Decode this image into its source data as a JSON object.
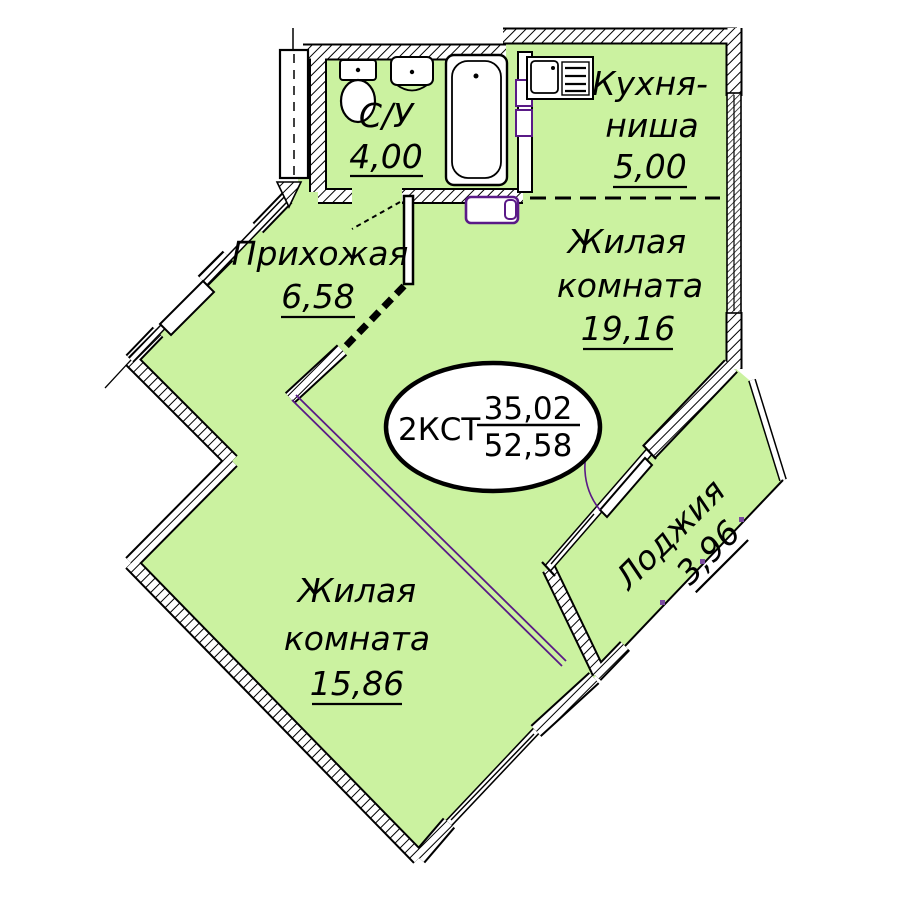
{
  "plan_summary": {
    "apartment_type": "2КСТ",
    "living_area": "35,02",
    "total_area": "52,58"
  },
  "rooms": {
    "bathroom": {
      "name": "С/У",
      "area": "4,00"
    },
    "kitchen_niche": {
      "name_line1": "Кухня-",
      "name_line2": "ниша",
      "area": "5,00"
    },
    "hallway": {
      "name": "Прихожая",
      "area": "6,58"
    },
    "living_room_large": {
      "name_line1": "Жилая",
      "name_line2": "комната",
      "area": "19,16"
    },
    "living_room_small": {
      "name_line1": "Жилая",
      "name_line2": "комната",
      "area": "15,86"
    },
    "loggia": {
      "name": "Лоджия",
      "area": "3,96"
    }
  },
  "colors": {
    "room_fill": "#cbf2a0",
    "wall": "#000000",
    "accent": "#5a1a87",
    "window_white": "#ffffff"
  }
}
